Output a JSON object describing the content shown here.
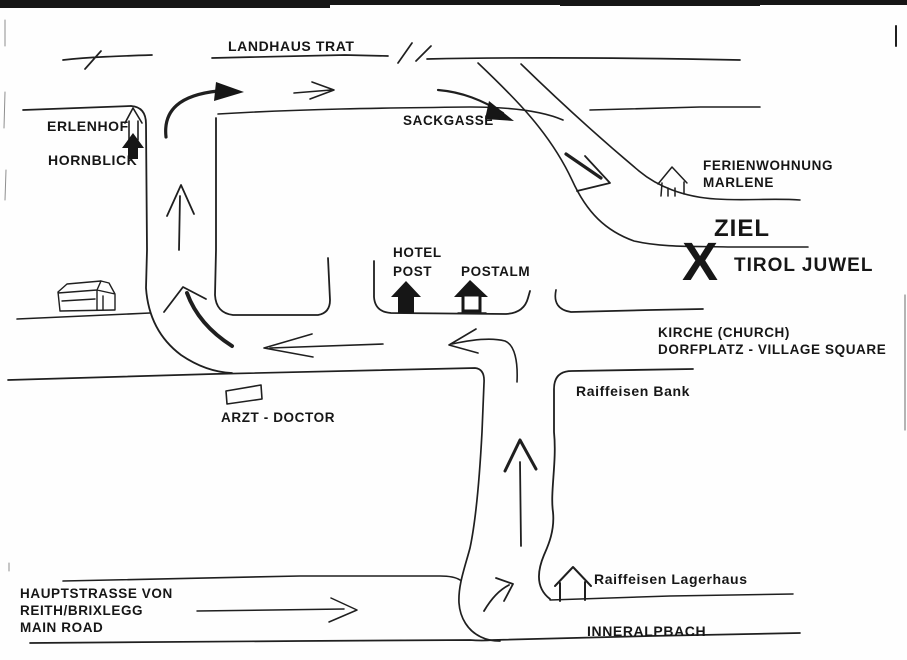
{
  "map": {
    "colors": {
      "ink": "#1f1f1f",
      "destination_red": "#e31a1c",
      "paper": "#fefefe"
    },
    "labels": {
      "landhaus_trat": "LANDHAUS TRAT",
      "erlenhof": "ERLENHOF",
      "hornblick": "HORNBLICK",
      "sackgasse": "SACKGASSE",
      "ferienwohnung_line1": "FERIENWOHNUNG",
      "ferienwohnung_line2": "MARLENE",
      "ziel": "ZIEL",
      "x_mark": "X",
      "tirol_juwel": "TIROL JUWEL",
      "hotel_line1": "HOTEL",
      "hotel_line2": "POST",
      "postalm": "POSTALM",
      "kirche": "KIRCHE (CHURCH)",
      "dorfplatz": "DORFPLATZ  - VILLAGE SQUARE",
      "raiffeisen_bank": "Raiffeisen Bank",
      "arzt_doctor": "ARZT - DOCTOR",
      "hauptstrasse_line1": "HAUPTSTRASSE VON",
      "hauptstrasse_line2": "REITH/BRIXLEGG",
      "hauptstrasse_line3": "MAIN ROAD",
      "raiffeisen_lagerhaus": "Raiffeisen Lagerhaus",
      "inneralpbach": "INNERALPBACH"
    }
  }
}
